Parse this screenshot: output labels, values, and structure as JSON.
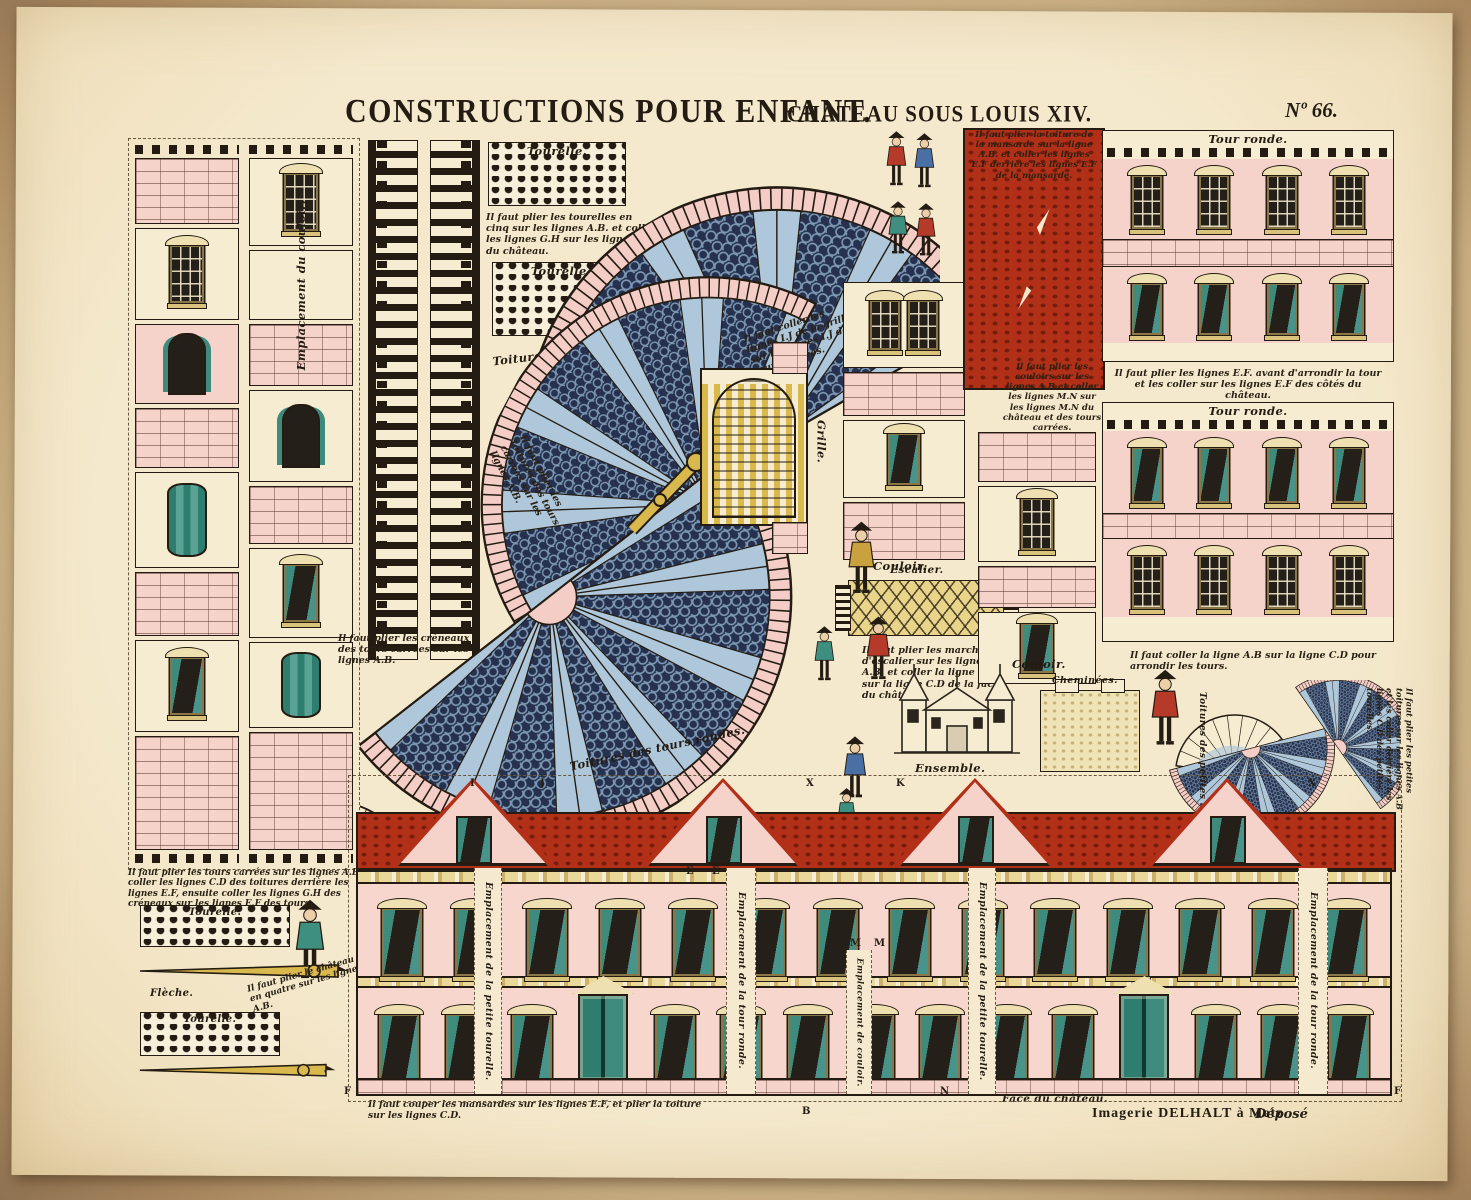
{
  "header": {
    "title": "CONSTRUCTIONS POUR ENFANT.",
    "subtitle": "CHÂTEAU SOUS LOUIS XIV.",
    "number": "Nº 66."
  },
  "footer": {
    "publisher": "Imagerie DELHALT à Metz",
    "deposit": "Déposé",
    "face_label": "Face du château."
  },
  "labels": {
    "tourelle": "Tourelle.",
    "tour_ronde": "Tour ronde.",
    "couloir": "Couloir.",
    "escalier": "Escalier.",
    "grille": "Grille.",
    "fleche": "Flèche.",
    "cheminees": "Cheminées.",
    "ensemble": "Ensemble.",
    "toiture_tour_carree": "Toiture de la tour carrée.",
    "toitures_tours_rondes": "Toitures des tours rondes.",
    "toitures_petites_tourelles": "Toitures des petites tourelles.",
    "emplacement_du_couloir": "Emplacement du couloir.",
    "emplacement_de_couloir": "Emplacement de couloir.",
    "emplacement_tour_ronde": "Emplacement de la tour ronde.",
    "emplacement_petite_tourelle": "Emplacement de la petite tourelle."
  },
  "instructions": {
    "i1": "Il faut plier les tourelles en cinq sur les lignes A.B. et coller les lignes G.H sur les lignes G.H du château.",
    "i2": "Il faut coller les lignes I.J de la grille sur les lignes I.J des tours carrées.",
    "i3": "Il faut plier la toiture de la mansarde sur la ligne A.B. et coller les lignes E.F derrière les lignes E.F de la mansarde.",
    "i4": "Il faut plier les lignes E.F. avant d'arrondir la tour et les coller sur les lignes E.F des côtés du château.",
    "i5": "Il faut coller la ligne A.B sur la ligne C.D pour arrondir les tours.",
    "i6": "Il faut plier les couloirs sur les lignes A.B et coller les lignes M.N sur les lignes M.N du château et des tours carrées.",
    "i7": "Il faut plier les marches d'escalier sur les lignes A.B. et coller la ligne C.D sur la ligne C.D de la face du château.",
    "i8": "Il faut plier les créneaux des tours carrées sur les lignes A.B.",
    "i9": "Il faut plier les tours carrées sur les lignes A.B et coller les lignes C.D des toitures derrière les lignes E.F, ensuite coller les lignes G.H des créneaux sur les lignes E.F des tours.",
    "i10": "Il faut couper les mansardes sur les lignes E.F, et plier la toiture sur les lignes C.D.",
    "i11": "Il faut plier les toitures des tours carrées sur les lignes A.B.",
    "i12": "Il faut plier le château en quatre sur les lignes A.B.",
    "i13": "Il faut plier les petites toitures sur les lignes A.B et les coller derrière les lignes C.D des petites tourelles."
  },
  "marks": {
    "a": "A",
    "b": "B",
    "e": "E",
    "f": "F",
    "i": "I",
    "j": "J",
    "k": "K",
    "m": "M",
    "n": "N",
    "x": "X"
  },
  "colors": {
    "paper": "#f5e9cd",
    "edge": "#a9885f",
    "ink": "#241c12",
    "pink_wall": "#f5d3ca",
    "roof_red": "#b23018",
    "fan_navy": "#25314e",
    "fan_blue": "#aec7da",
    "teal": "#3e8a7c",
    "straw": "#e3cc7e"
  }
}
